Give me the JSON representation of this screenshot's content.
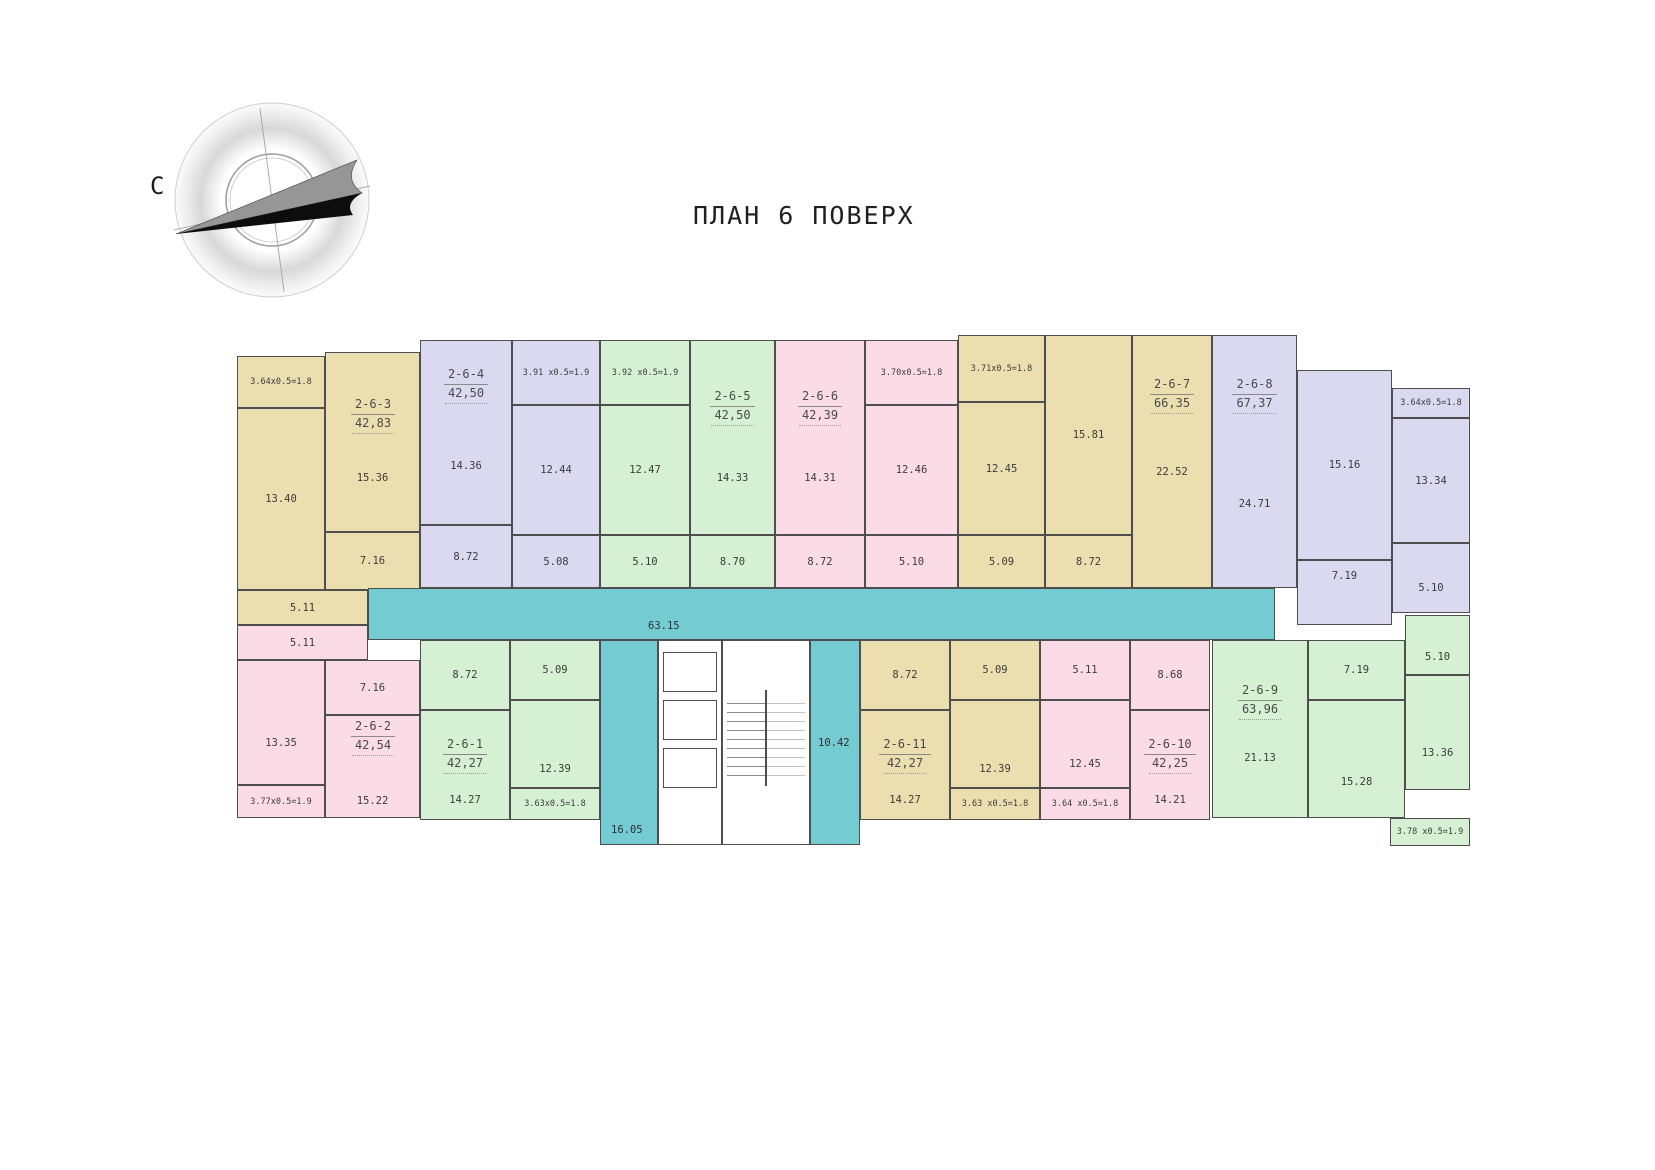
{
  "title": "ПЛАН 6 ПОВЕРХ",
  "compass": {
    "north": "С"
  },
  "common": {
    "corridor": "63.15",
    "lobby_left": "16.05",
    "lobby_right": "10.42"
  },
  "apartments": [
    {
      "id": "2-6-3",
      "area": "42,83",
      "balcony": "3.64x0.5=1.8",
      "rooms": [
        "13.40",
        "15.36",
        "7.16",
        "5.11"
      ]
    },
    {
      "id": "2-6-4",
      "area": "42,50",
      "balcony": "3.91 x0.5=1.9",
      "rooms": [
        "14.36",
        "12.44",
        "8.72",
        "5.08"
      ]
    },
    {
      "id": "2-6-5",
      "area": "42,50",
      "balcony": "3.92 x0.5=1.9",
      "rooms": [
        "12.47",
        "14.33",
        "8.70",
        "5.10"
      ]
    },
    {
      "id": "2-6-6",
      "area": "42,39",
      "balcony": "3.70x0.5=1.8",
      "rooms": [
        "14.31",
        "12.46",
        "8.72",
        "5.10"
      ]
    },
    {
      "id": "2-6-7",
      "area": "66,35",
      "balcony": "3.71x0.5=1.8",
      "rooms": [
        "12.45",
        "15.81",
        "22.52",
        "8.72",
        "5.09"
      ]
    },
    {
      "id": "2-6-8",
      "area": "67,37",
      "balcony": "3.64x0.5=1.8",
      "rooms": [
        "24.71",
        "15.16",
        "13.34",
        "7.19",
        "5.10"
      ]
    },
    {
      "id": "2-6-2",
      "area": "42,54",
      "balcony": "3.77x0.5=1.9",
      "rooms": [
        "5.11",
        "7.16",
        "13.35",
        "15.22"
      ]
    },
    {
      "id": "2-6-1",
      "area": "42,27",
      "balcony": "3.63x0.5=1.8",
      "rooms": [
        "8.72",
        "5.09",
        "12.39",
        "14.27"
      ]
    },
    {
      "id": "2-6-11",
      "area": "42,27",
      "balcony": "3.63 x0.5=1.8",
      "rooms": [
        "8.72",
        "5.09",
        "12.39",
        "14.27"
      ]
    },
    {
      "id": "2-6-10",
      "area": "42,25",
      "balcony": "3.64 x0.5=1.8",
      "rooms": [
        "5.11",
        "8.68",
        "12.45",
        "14.21"
      ]
    },
    {
      "id": "2-6-9",
      "area": "63,96",
      "balcony": "3.78 x0.5=1.9",
      "rooms": [
        "21.13",
        "7.19",
        "15.28",
        "5.10",
        "13.36"
      ]
    }
  ]
}
